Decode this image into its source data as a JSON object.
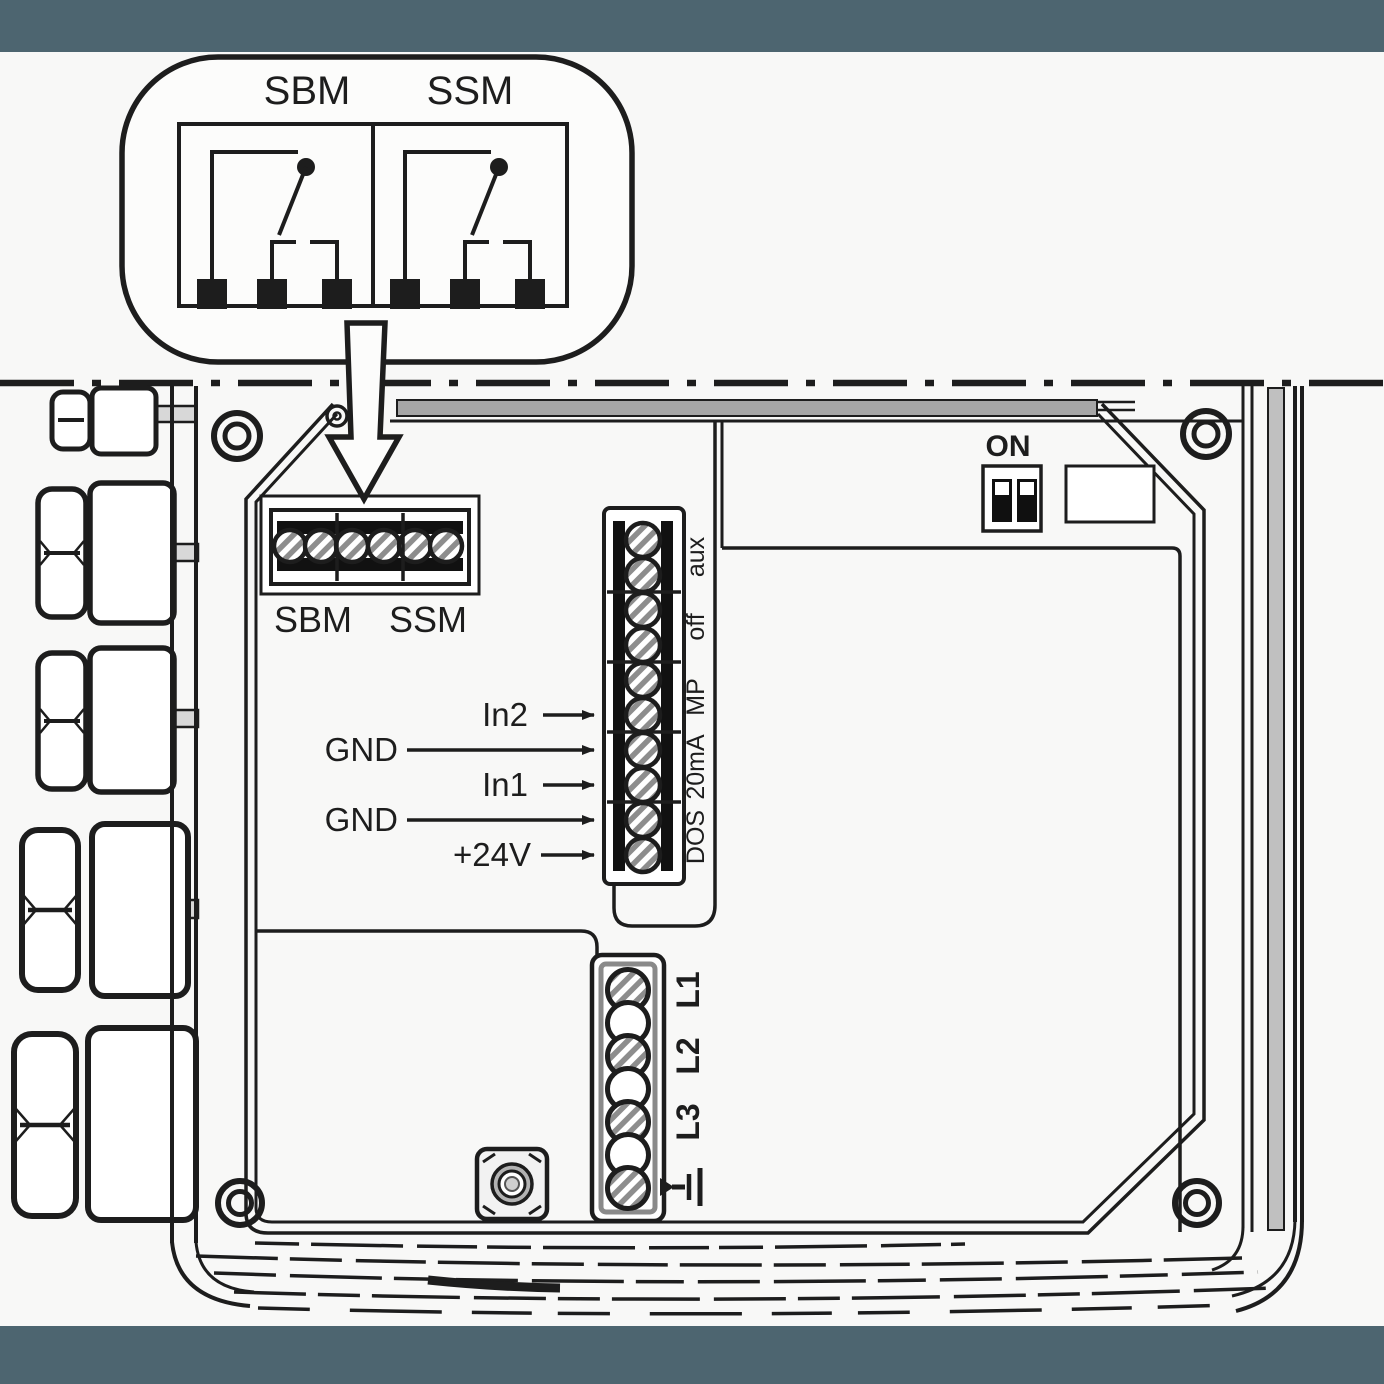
{
  "colors": {
    "band": "#4d6570",
    "line": "#1d1d1d",
    "background": "#f8f8f7",
    "gray_strip": "#a6a6a6",
    "hatch_gray": "#8d8d8d"
  },
  "callout": {
    "sbm_label": "SBM",
    "ssm_label": "SSM"
  },
  "board": {
    "relay_block": {
      "sbm_label": "SBM",
      "ssm_label": "SSM"
    },
    "dip_switch": {
      "label": "ON"
    },
    "io_labels": [
      {
        "text": "In2"
      },
      {
        "text": "GND"
      },
      {
        "text": "In1"
      },
      {
        "text": "GND"
      },
      {
        "text": "+24V"
      }
    ],
    "signal_strip_labels": [
      {
        "text": "aux"
      },
      {
        "text": "off"
      },
      {
        "text": "MP"
      },
      {
        "text": "20mA"
      },
      {
        "text": "DOS"
      }
    ],
    "power_labels": [
      {
        "text": "L1"
      },
      {
        "text": "L2"
      },
      {
        "text": "L3"
      }
    ]
  },
  "icons": {
    "ground_symbol": "earth-ground-icon",
    "callout_arrow": "block-arrow-down-icon",
    "dip_switch": "dip-switch-icon",
    "corner_screw": "screw-head-icon"
  }
}
